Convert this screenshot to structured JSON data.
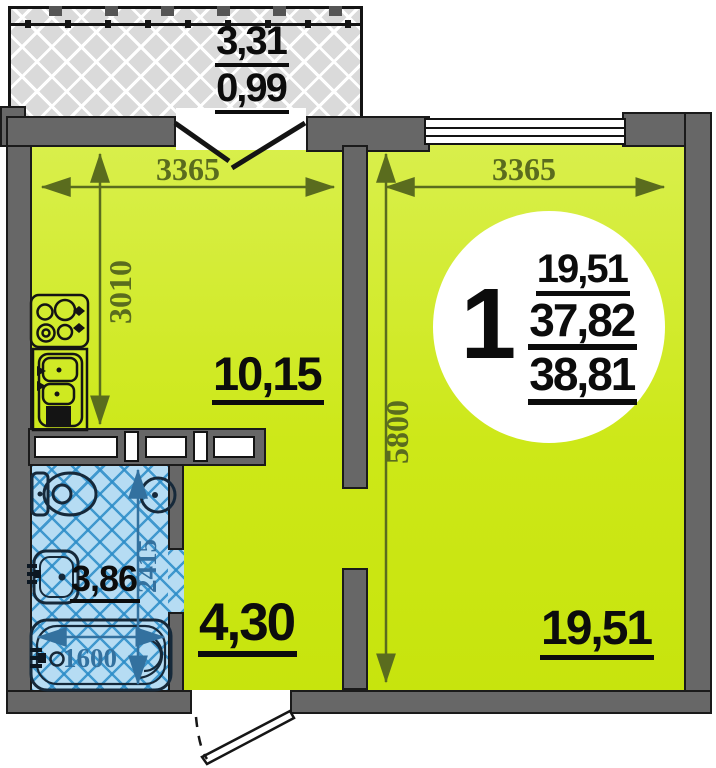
{
  "plan_title": "one-room apartment floor plan",
  "balcony": {
    "area_total": "3,31",
    "area_reduced": "0,99"
  },
  "kitchen": {
    "area": "10,15",
    "width_mm": "3365",
    "depth_mm": "3010"
  },
  "living_room": {
    "area": "19,51",
    "width_mm": "3365",
    "depth_mm": "5800"
  },
  "hallway": {
    "area": "4,30"
  },
  "bathroom": {
    "area": "3,86",
    "depth_mm": "2415",
    "bath_length_mm": "1600"
  },
  "stamp": {
    "rooms_count": "1",
    "living_area": "19,51",
    "area_no_balcony": "37,82",
    "total_area": "38,81"
  },
  "colors": {
    "floor_green": "#cde818",
    "wall_gray": "#676767",
    "bath_tile_blue": "#b6dcf3",
    "dim_olive": "#5a6c1e",
    "dim_blue": "#33719f",
    "label_black": "#0c0c0c"
  }
}
